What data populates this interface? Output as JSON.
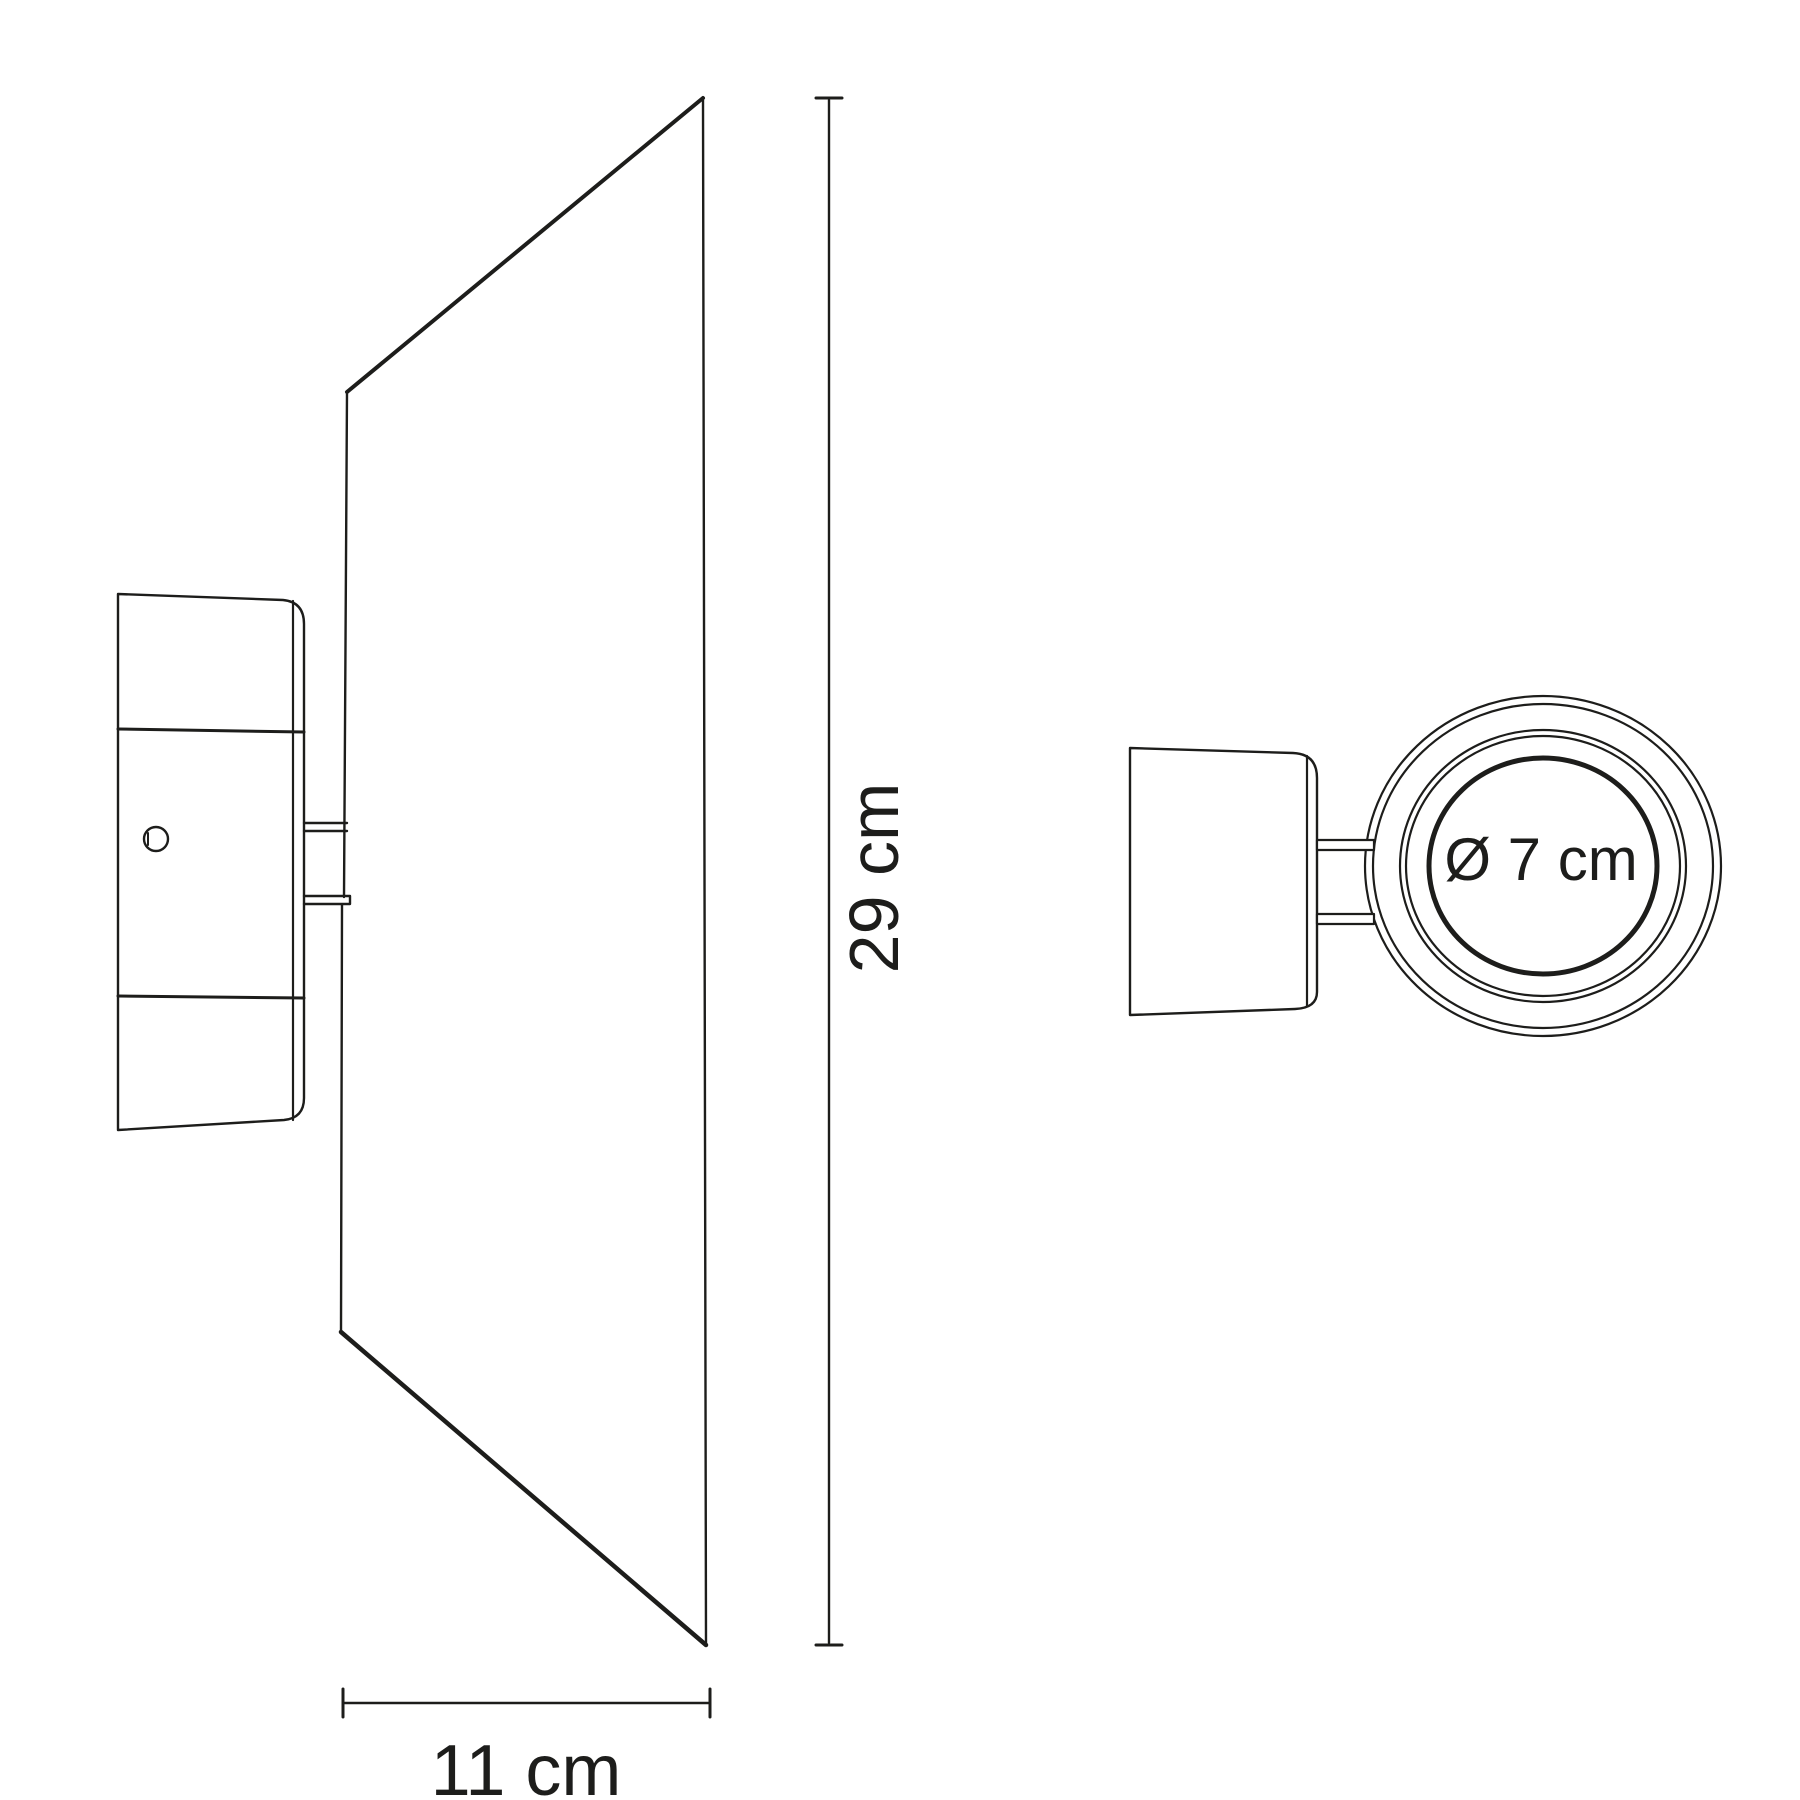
{
  "diagram": {
    "background_color": "#ffffff",
    "line_color": "#1d1d1b",
    "labels": {
      "height": "29 cm",
      "depth": "11 cm",
      "diameter": "Ø 7 cm"
    }
  }
}
